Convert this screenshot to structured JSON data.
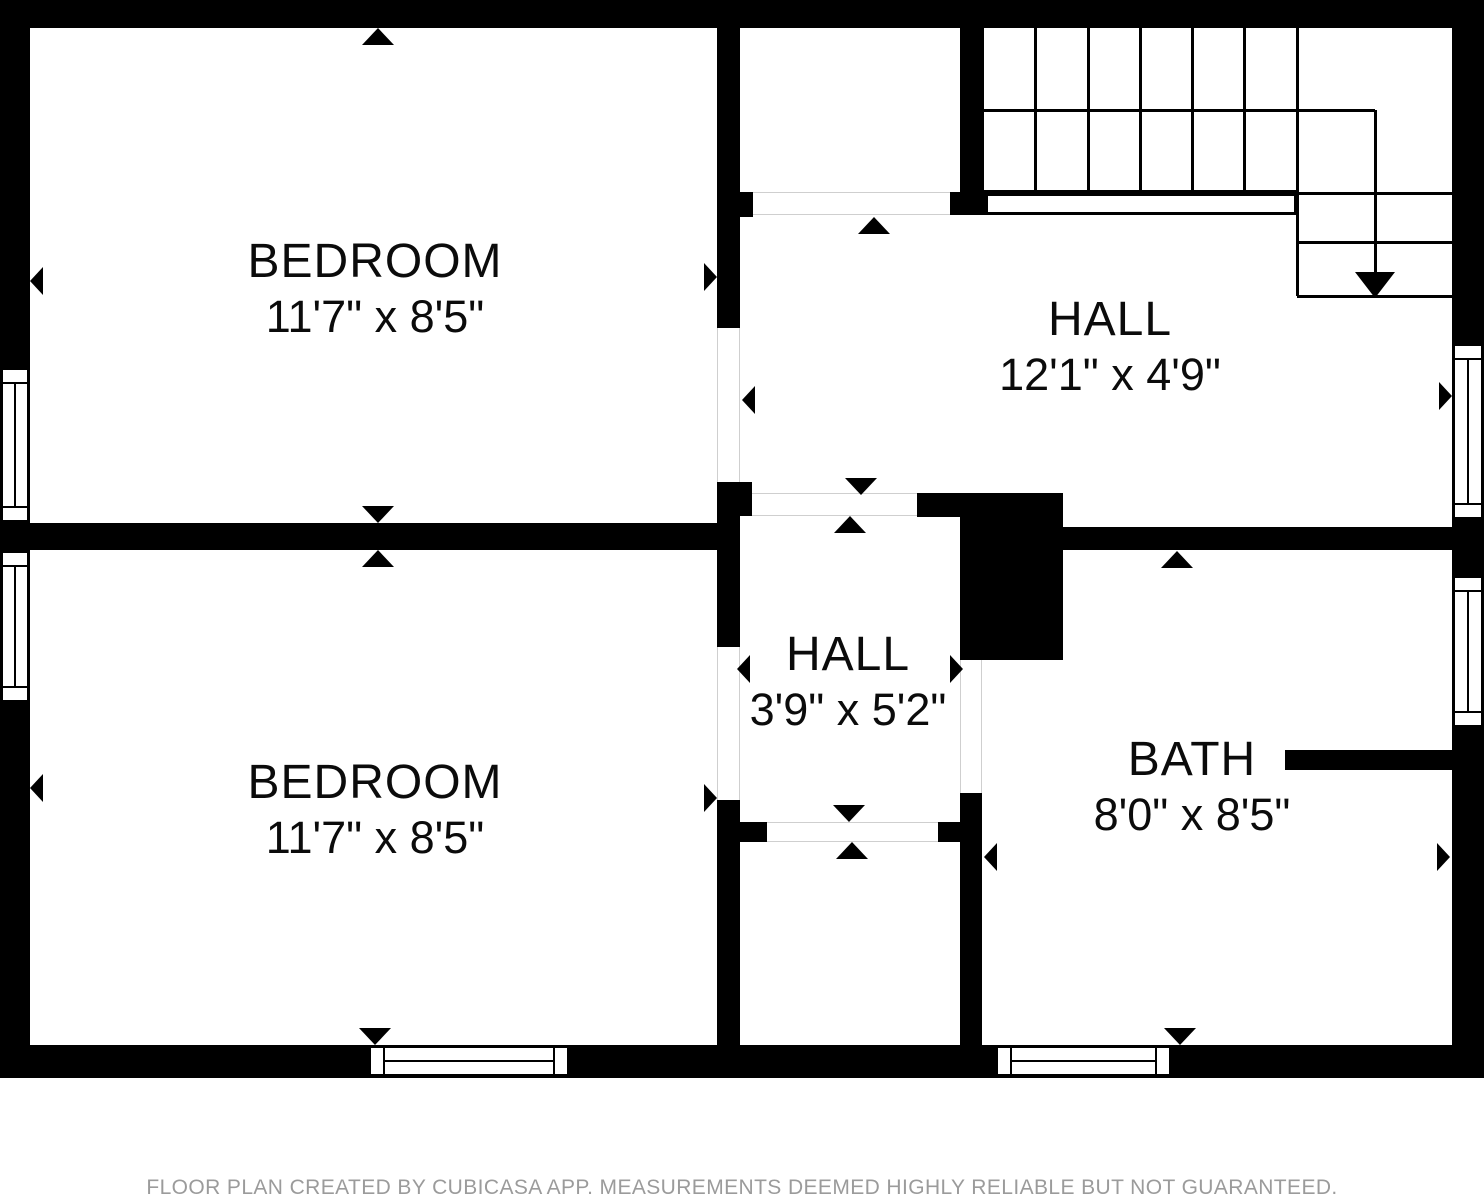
{
  "footer": {
    "text": "FLOOR PLAN CREATED BY CUBICASA APP. MEASUREMENTS DEEMED HIGHLY RELIABLE BUT NOT GUARANTEED.",
    "y": 1176
  },
  "colors": {
    "wall": "#000000",
    "background": "#ffffff",
    "threshold_line": "#cfcfcf",
    "footer_text": "#9b9b9b",
    "label_text": "#0b0b0b"
  },
  "rooms": [
    {
      "id": "bedroom-top",
      "name": "BEDROOM",
      "dims": "11'7\" x 8'5\"",
      "cx": 375,
      "top": 236
    },
    {
      "id": "bedroom-bottom",
      "name": "BEDROOM",
      "dims": "11'7\" x 8'5\"",
      "cx": 375,
      "top": 757
    },
    {
      "id": "hall-top",
      "name": "HALL",
      "dims": "12'1\" x 4'9\"",
      "cx": 1110,
      "top": 294
    },
    {
      "id": "hall-small",
      "name": "HALL",
      "dims": "3'9\" x 5'2\"",
      "cx": 848,
      "top": 629
    },
    {
      "id": "bath",
      "name": "BATH",
      "dims": "8'0\" x 8'5\"",
      "cx": 1192,
      "top": 734
    }
  ],
  "walls": [
    {
      "x": 0,
      "y": 0,
      "w": 1484,
      "h": 28
    },
    {
      "x": 0,
      "y": 28,
      "w": 30,
      "h": 1050
    },
    {
      "x": 0,
      "y": 1045,
      "w": 1484,
      "h": 33
    },
    {
      "x": 1452,
      "y": 28,
      "w": 32,
      "h": 1050
    },
    {
      "x": 717,
      "y": 28,
      "w": 23,
      "h": 164
    },
    {
      "x": 717,
      "y": 192,
      "w": 36,
      "h": 25
    },
    {
      "x": 717,
      "y": 217,
      "w": 23,
      "h": 111
    },
    {
      "x": 717,
      "y": 482,
      "w": 35,
      "h": 34
    },
    {
      "x": 717,
      "y": 516,
      "w": 23,
      "h": 131
    },
    {
      "x": 717,
      "y": 800,
      "w": 23,
      "h": 245
    },
    {
      "x": 0,
      "y": 523,
      "w": 740,
      "h": 27
    },
    {
      "x": 960,
      "y": 28,
      "w": 22,
      "h": 164
    },
    {
      "x": 950,
      "y": 192,
      "w": 35,
      "h": 23
    },
    {
      "x": 917,
      "y": 493,
      "w": 146,
      "h": 24
    },
    {
      "x": 960,
      "y": 493,
      "w": 103,
      "h": 167
    },
    {
      "x": 960,
      "y": 793,
      "w": 22,
      "h": 252
    },
    {
      "x": 938,
      "y": 822,
      "w": 24,
      "h": 20
    },
    {
      "x": 740,
      "y": 822,
      "w": 27,
      "h": 20
    },
    {
      "x": 1063,
      "y": 527,
      "w": 389,
      "h": 23
    },
    {
      "x": 1285,
      "y": 750,
      "w": 167,
      "h": 20
    }
  ],
  "windows": [
    {
      "x": 0,
      "y": 367,
      "w": 30,
      "h": 156,
      "o": "v"
    },
    {
      "x": 0,
      "y": 550,
      "w": 30,
      "h": 153,
      "o": "v"
    },
    {
      "x": 368,
      "y": 1045,
      "w": 202,
      "h": 32,
      "o": "h"
    },
    {
      "x": 995,
      "y": 1045,
      "w": 177,
      "h": 32,
      "o": "h"
    },
    {
      "x": 1452,
      "y": 343,
      "w": 32,
      "h": 177,
      "o": "v"
    },
    {
      "x": 1452,
      "y": 575,
      "w": 32,
      "h": 153,
      "o": "v"
    }
  ],
  "thresholds": [
    {
      "x": 753,
      "y": 192,
      "w": 197,
      "h": 23,
      "o": "h"
    },
    {
      "x": 752,
      "y": 493,
      "w": 165,
      "h": 23,
      "o": "h"
    },
    {
      "x": 767,
      "y": 822,
      "w": 171,
      "h": 20,
      "o": "h"
    }
  ],
  "door_openings": [
    {
      "x": 717,
      "y": 328,
      "w": 23,
      "h": 154,
      "o": "v"
    },
    {
      "x": 717,
      "y": 647,
      "w": 23,
      "h": 153,
      "o": "v"
    },
    {
      "x": 960,
      "y": 660,
      "w": 22,
      "h": 133,
      "o": "v"
    }
  ],
  "stairs": {
    "vlines": [
      [
        982,
        28,
        191
      ],
      [
        1035,
        28,
        191
      ],
      [
        1088,
        28,
        191
      ],
      [
        1140,
        28,
        191
      ],
      [
        1192,
        28,
        191
      ],
      [
        1244,
        28,
        191
      ],
      [
        1297,
        28,
        296
      ],
      [
        1375,
        110,
        276
      ]
    ],
    "hlines": [
      [
        110,
        982,
        1375
      ],
      [
        191,
        982,
        1297
      ],
      [
        193,
        1297,
        1452
      ],
      [
        242,
        1297,
        1452
      ],
      [
        296,
        1297,
        1452
      ]
    ],
    "strip": {
      "x": 985,
      "y": 193,
      "w": 312,
      "h": 22
    },
    "down_arrow": {
      "x": 1375,
      "y": 298,
      "w": 40,
      "h": 26
    }
  },
  "arrows": [
    {
      "x": 378,
      "y": 28,
      "d": "up"
    },
    {
      "x": 30,
      "y": 281,
      "d": "left"
    },
    {
      "x": 717,
      "y": 277,
      "d": "right"
    },
    {
      "x": 378,
      "y": 523,
      "d": "down"
    },
    {
      "x": 378,
      "y": 550,
      "d": "up"
    },
    {
      "x": 30,
      "y": 788,
      "d": "left"
    },
    {
      "x": 717,
      "y": 798,
      "d": "right"
    },
    {
      "x": 375,
      "y": 1045,
      "d": "down"
    },
    {
      "x": 874,
      "y": 217,
      "d": "up"
    },
    {
      "x": 742,
      "y": 400,
      "d": "left"
    },
    {
      "x": 1452,
      "y": 396,
      "d": "right"
    },
    {
      "x": 861,
      "y": 495,
      "d": "down"
    },
    {
      "x": 850,
      "y": 516,
      "d": "up"
    },
    {
      "x": 737,
      "y": 669,
      "d": "left"
    },
    {
      "x": 963,
      "y": 669,
      "d": "right"
    },
    {
      "x": 849,
      "y": 822,
      "d": "down"
    },
    {
      "x": 852,
      "y": 842,
      "d": "up"
    },
    {
      "x": 1177,
      "y": 551,
      "d": "up"
    },
    {
      "x": 984,
      "y": 857,
      "d": "left"
    },
    {
      "x": 1450,
      "y": 857,
      "d": "right"
    },
    {
      "x": 1180,
      "y": 1045,
      "d": "down"
    }
  ]
}
